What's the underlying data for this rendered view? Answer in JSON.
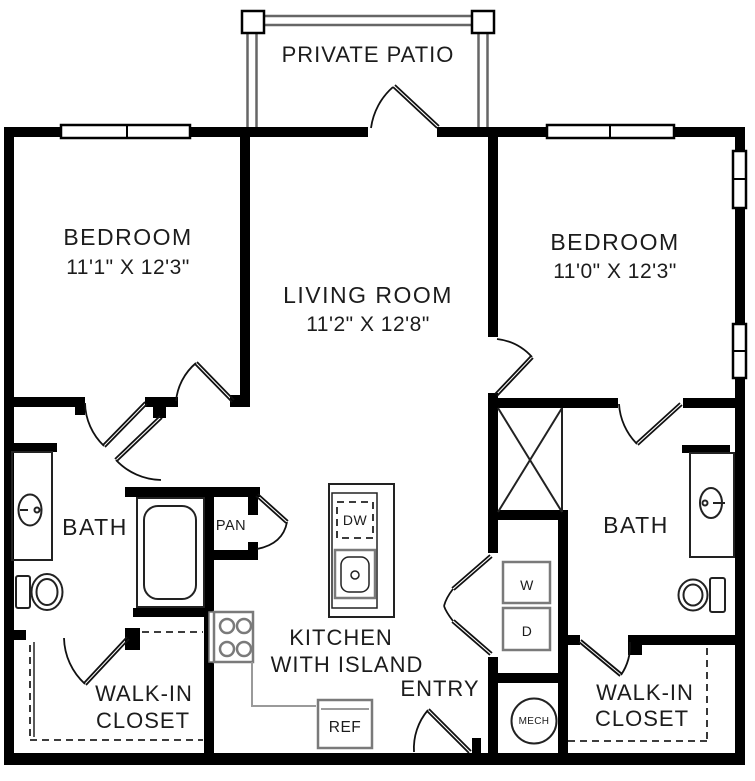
{
  "floorplan": {
    "patio": {
      "label": "PRIVATE PATIO"
    },
    "rooms": {
      "bedroom_left": {
        "label": "BEDROOM",
        "dims": "11'1\" X 12'3\""
      },
      "bedroom_right": {
        "label": "BEDROOM",
        "dims": "11'0\" X 12'3\""
      },
      "living_room": {
        "label": "LIVING ROOM",
        "dims": "11'2\" X 12'8\""
      },
      "bath_left": {
        "label": "BATH"
      },
      "bath_right": {
        "label": "BATH"
      },
      "pantry": {
        "label": "PAN"
      },
      "kitchen": {
        "label_line1": "KITCHEN",
        "label_line2": "WITH ISLAND"
      },
      "entry": {
        "label": "ENTRY"
      },
      "walk_in_closet_left": {
        "label_line1": "WALK-IN",
        "label_line2": "CLOSET"
      },
      "walk_in_closet_right": {
        "label_line1": "WALK-IN",
        "label_line2": "CLOSET"
      }
    },
    "appliances": {
      "dishwasher": "DW",
      "refrigerator": "REF",
      "washer": "W",
      "dryer": "D",
      "mechanical": "MECH"
    },
    "colors": {
      "walls": "#000000",
      "fixtures": "#7a7a7a",
      "thin_lines": "#222222",
      "text": "#1c1c1c",
      "background": "#ffffff"
    }
  }
}
